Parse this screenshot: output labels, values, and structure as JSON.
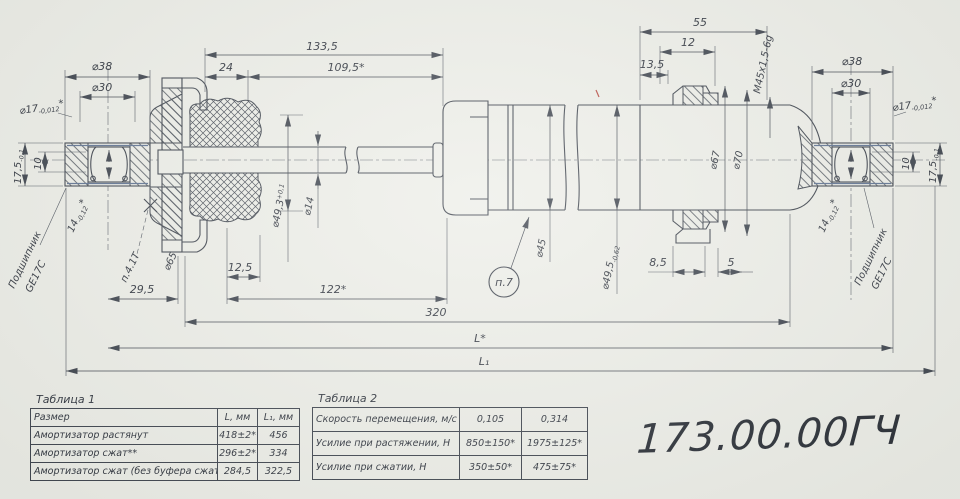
{
  "paper": {
    "part_number": "173.00.00ГЧ"
  },
  "tables": {
    "t1": {
      "caption": "Таблица 1",
      "col1": "Размер",
      "col2": "L, мм",
      "col3": "L₁, мм",
      "rows": [
        {
          "name": "Амортизатор растянут",
          "l": "418±2*",
          "l1": "456"
        },
        {
          "name": "Амортизатор сжат**",
          "l": "296±2*",
          "l1": "334"
        },
        {
          "name": "Амортизатор сжат (без буфера сжатия)",
          "l": "284,5",
          "l1": "322,5"
        }
      ]
    },
    "t2": {
      "caption": "Таблица 2",
      "rows": [
        {
          "name": "Скорость перемещения, м/с",
          "v1": "0,105",
          "v2": "0,314"
        },
        {
          "name": "Усилие при растяжении, Н",
          "v1": "850±150*",
          "v2": "1975±125*"
        },
        {
          "name": "Усилие при сжатии, Н",
          "v1": "350±50*",
          "v2": "475±75*"
        }
      ]
    }
  },
  "dims": {
    "total_len": "133,5",
    "rod_24": "24",
    "rod_109": "109,5*",
    "res_55": "55",
    "res_12": "12",
    "res_135": "13,5",
    "thread": "М45х1,5-6g",
    "bot_295": "29,5",
    "bot_125": "12,5",
    "bot_122": "122*",
    "bot_320": "320",
    "len_L": "L*",
    "len_L1": "L₁",
    "d45": "⌀45",
    "d14": "⌀14",
    "d493": "⌀49,3",
    "d493_tol": "+0,1",
    "d495": "⌀49,5",
    "d495_tol": "-0,62",
    "d67": "⌀67",
    "d70": "⌀70",
    "col_85": "8,5",
    "col_5": "5",
    "cup_d65": "⌀65"
  },
  "eye": {
    "d38": "⌀38",
    "d30": "⌀30",
    "d17": "⌀17",
    "d17_tol": "-0,012",
    "d17_star": "*",
    "h175": "17,5",
    "h175_tol": "-0,1",
    "bore10": "10",
    "w14": "14",
    "w14_tol": "-0,12",
    "w14_star": "*",
    "bearing1": "Подшипник",
    "bearing2": "GE17C"
  },
  "notes": {
    "n7": "п.7",
    "n41": "п.4.1Т"
  }
}
